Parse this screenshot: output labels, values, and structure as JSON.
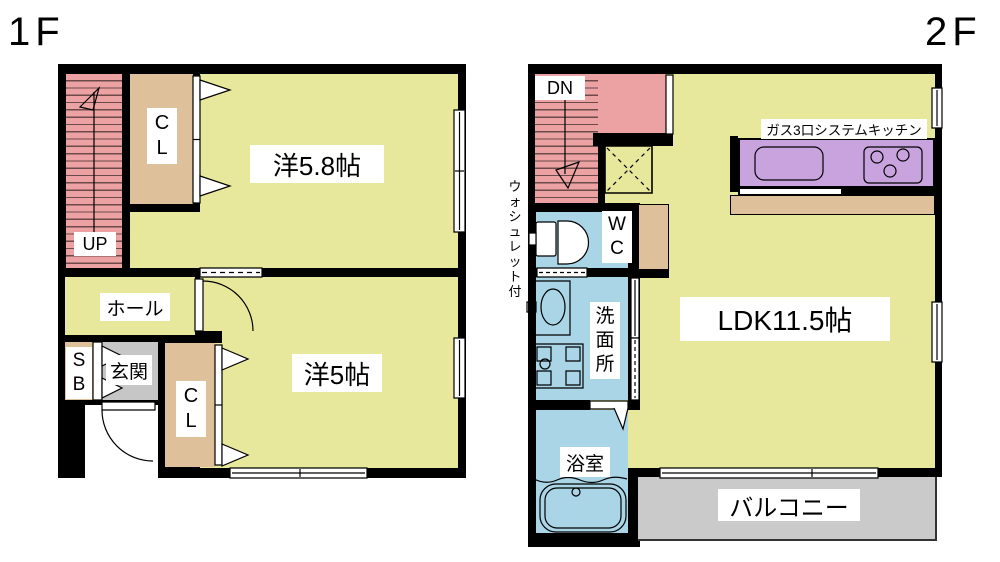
{
  "colors": {
    "wall": "#000000",
    "room": "#E7E89B",
    "pink": "#ECA2A2",
    "stripe": "#6b4a4a",
    "tan": "#DEC09B",
    "gray": "#C6C6C6",
    "blue": "#A9D5E7",
    "purple": "#C9A3DE",
    "balcony": "#CACACA"
  },
  "floor1": {
    "title": "1F",
    "stair": "UP",
    "closet_top": "CL",
    "closet_bottom": "CL",
    "shoebox": "SB",
    "hall": "ホール",
    "entrance": "玄関",
    "room_5_8": "洋5.8帖",
    "room_5": "洋5帖"
  },
  "floor2": {
    "title": "2F",
    "stair": "DN",
    "toilet": "WC",
    "toilet_note": "ウォシュレット付",
    "kitchen": "ガス3口システムキッチン",
    "washroom": "洗面所",
    "bathroom": "浴室",
    "living": "LDK11.5帖",
    "balcony": "バルコニー"
  }
}
